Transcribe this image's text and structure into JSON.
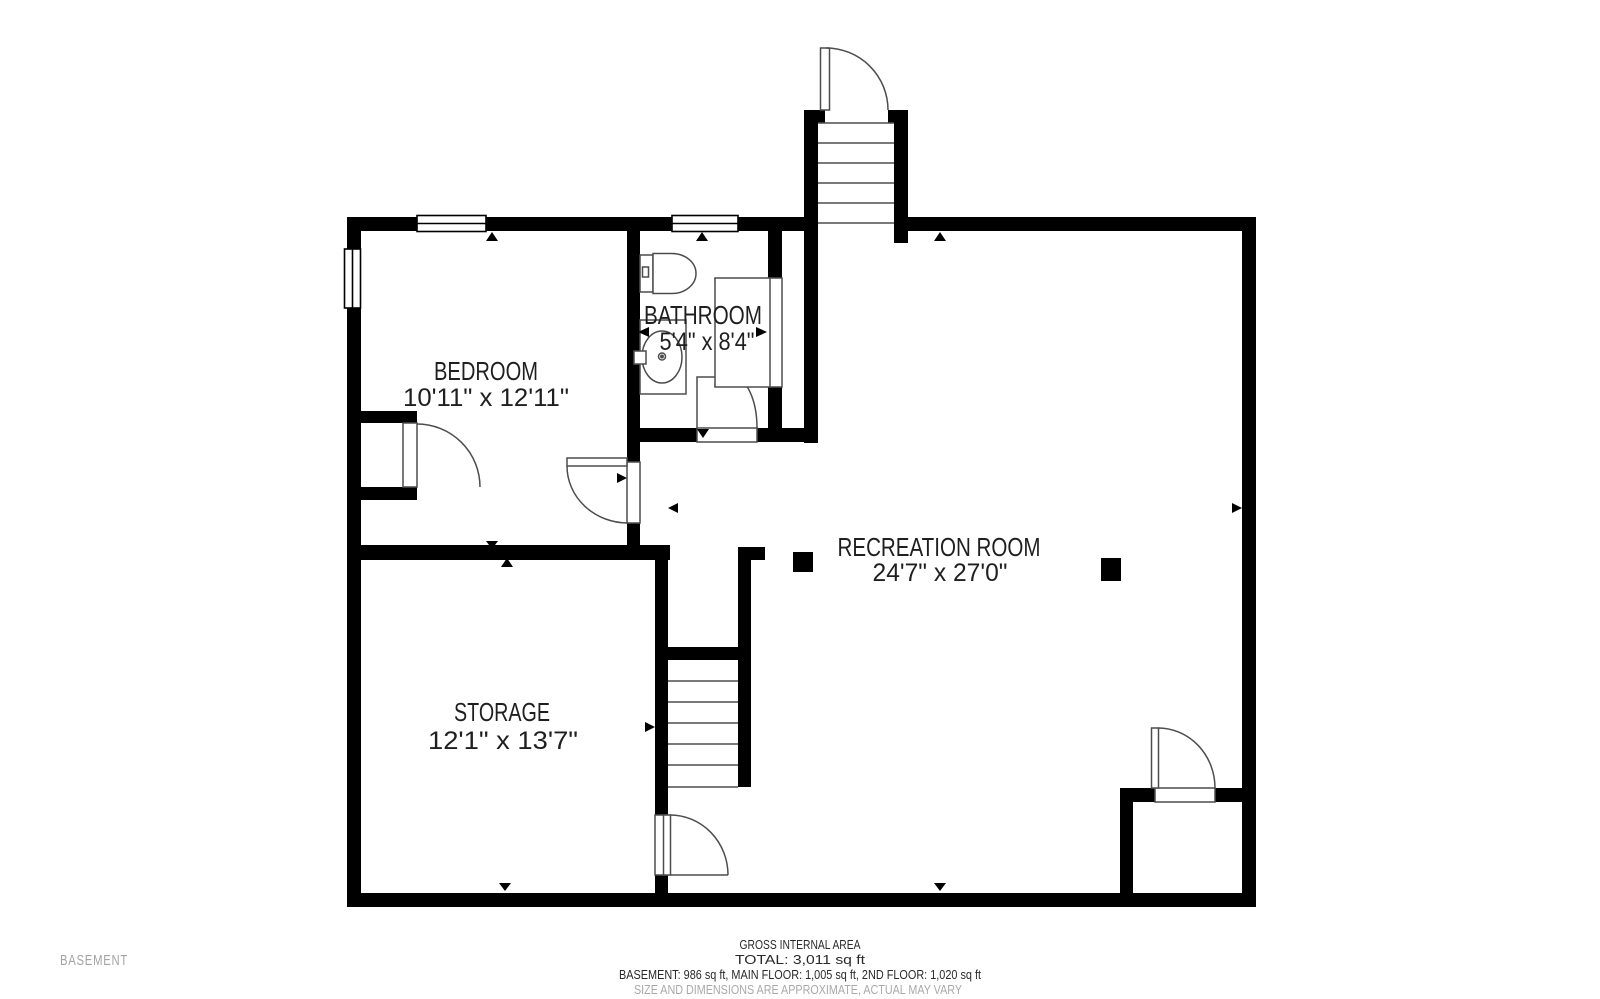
{
  "floor_plan": {
    "floor_label": "BASEMENT",
    "rooms": {
      "bedroom": {
        "name": "BEDROOM",
        "dims": "10'11\" x 12'11\""
      },
      "bathroom": {
        "name": "BATHROOM",
        "dims": "5'4\" x 8'4\""
      },
      "recreation": {
        "name": "RECREATION ROOM",
        "dims": "24'7\" x 27'0\""
      },
      "storage": {
        "name": "STORAGE",
        "dims": "12'1\" x 13'7\""
      }
    }
  },
  "footer": {
    "title": "GROSS INTERNAL AREA",
    "total": "TOTAL: 3,011 sq ft",
    "breakdown": "BASEMENT: 986 sq ft, MAIN FLOOR: 1,005 sq ft, 2ND FLOOR: 1,020 sq ft",
    "disclaimer": "SIZE AND DIMENSIONS ARE APPROXIMATE, ACTUAL MAY VARY"
  },
  "colors": {
    "wall": "#000000",
    "label": "#1f1f1f",
    "muted": "#a3a3a3",
    "thin_line": "#4d4d4d"
  }
}
